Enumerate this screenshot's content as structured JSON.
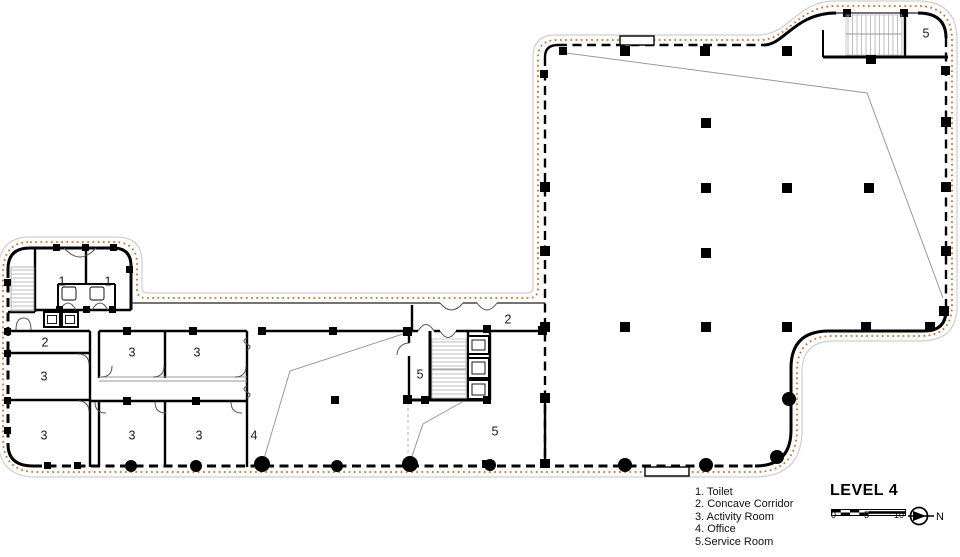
{
  "title": "LEVEL 4",
  "legend": {
    "items": [
      "1. Toilet",
      "2. Concave Corridor",
      "3. Activity Room",
      "4. Office",
      "5.Service Room"
    ]
  },
  "scalebar": {
    "ticks": [
      "0",
      "5",
      "10"
    ]
  },
  "north": {
    "label": "N"
  },
  "colors": {
    "wall": "#000000",
    "outline": "#c0763a",
    "thin": "#999999",
    "hatch": "#b8b8b8"
  },
  "rooms": [
    {
      "label": "1",
      "x": 62,
      "y": 282
    },
    {
      "label": "1",
      "x": 108,
      "y": 282
    },
    {
      "label": "2",
      "x": 45,
      "y": 343
    },
    {
      "label": "3",
      "x": 44,
      "y": 377
    },
    {
      "label": "3",
      "x": 44,
      "y": 436
    },
    {
      "label": "3",
      "x": 132,
      "y": 353
    },
    {
      "label": "3",
      "x": 197,
      "y": 353
    },
    {
      "label": "3",
      "x": 132,
      "y": 436
    },
    {
      "label": "3",
      "x": 199,
      "y": 436
    },
    {
      "label": "4",
      "x": 254,
      "y": 436
    },
    {
      "label": "5",
      "x": 420,
      "y": 375
    },
    {
      "label": "2",
      "x": 508,
      "y": 320
    },
    {
      "label": "5",
      "x": 495,
      "y": 432
    },
    {
      "label": "5",
      "x": 926,
      "y": 34
    }
  ]
}
